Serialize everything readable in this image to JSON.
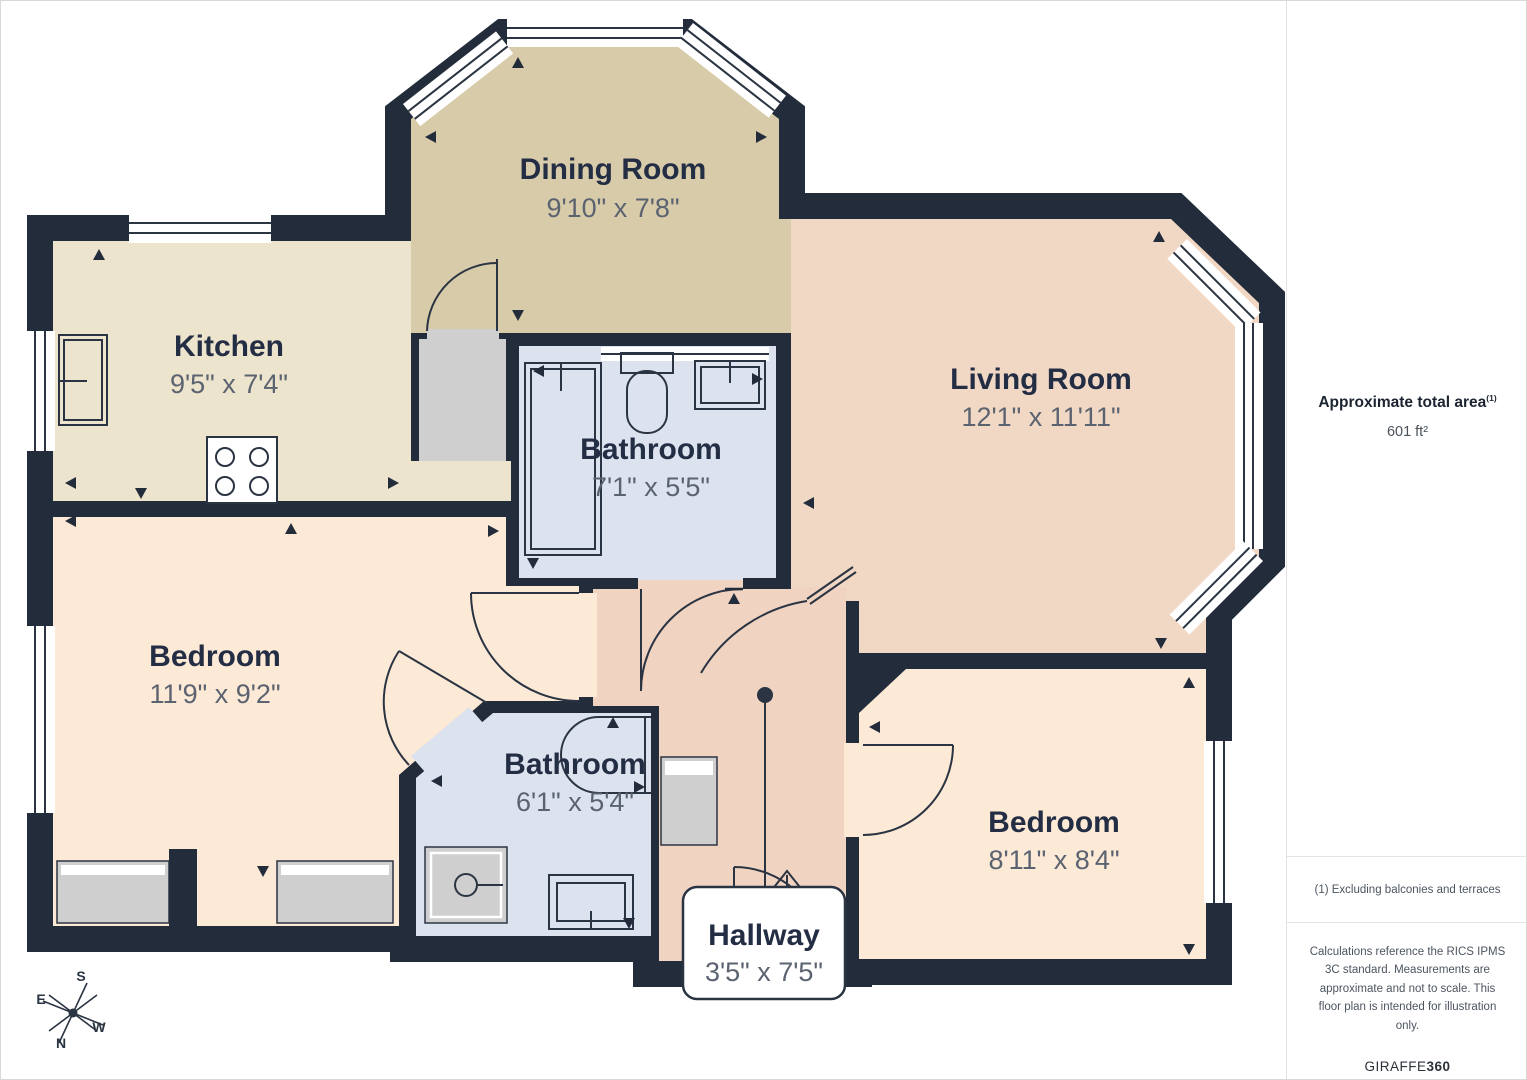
{
  "rooms": [
    {
      "id": "dining-room",
      "name": "Dining Room",
      "dims": "9'10\" x 7'8\""
    },
    {
      "id": "kitchen",
      "name": "Kitchen",
      "dims": "9'5\" x 7'4\""
    },
    {
      "id": "living-room",
      "name": "Living Room",
      "dims": "12'1\" x 11'11\""
    },
    {
      "id": "bathroom-1",
      "name": "Bathroom",
      "dims": "7'1\" x 5'5\""
    },
    {
      "id": "bedroom-1",
      "name": "Bedroom",
      "dims": "11'9\" x 9'2\""
    },
    {
      "id": "bathroom-2",
      "name": "Bathroom",
      "dims": "6'1\" x 5'4\""
    },
    {
      "id": "bedroom-2",
      "name": "Bedroom",
      "dims": "8'11\" x 8'4\""
    },
    {
      "id": "hallway",
      "name": "Hallway",
      "dims": "3'5\" x 7'5\""
    }
  ],
  "sidebar": {
    "area_label": "Approximate total area",
    "area_footnote_marker": "(1)",
    "area_value": "601 ft²",
    "footnote": "(1) Excluding balconies and terraces",
    "disclaimer": "Calculations reference the RICS IPMS 3C standard. Measurements are approximate and not to scale. This floor plan is intended for illustration only.",
    "brand_name": "GIRAFFE",
    "brand_suffix": "360"
  },
  "compass": {
    "s": "S",
    "e": "E",
    "w": "W",
    "n": "N"
  },
  "colors": {
    "walls": "#232C3A",
    "dining": "#D7CBA9",
    "kitchen": "#ECE4CC",
    "living": "#F1D8C5",
    "hallway": "#F0D3C1",
    "bedroom": "#FCE9D6",
    "bathroom": "#DCE2EE",
    "vestibule": "#CFCFCF",
    "label": "#232D44",
    "dims": "#5B6370"
  }
}
